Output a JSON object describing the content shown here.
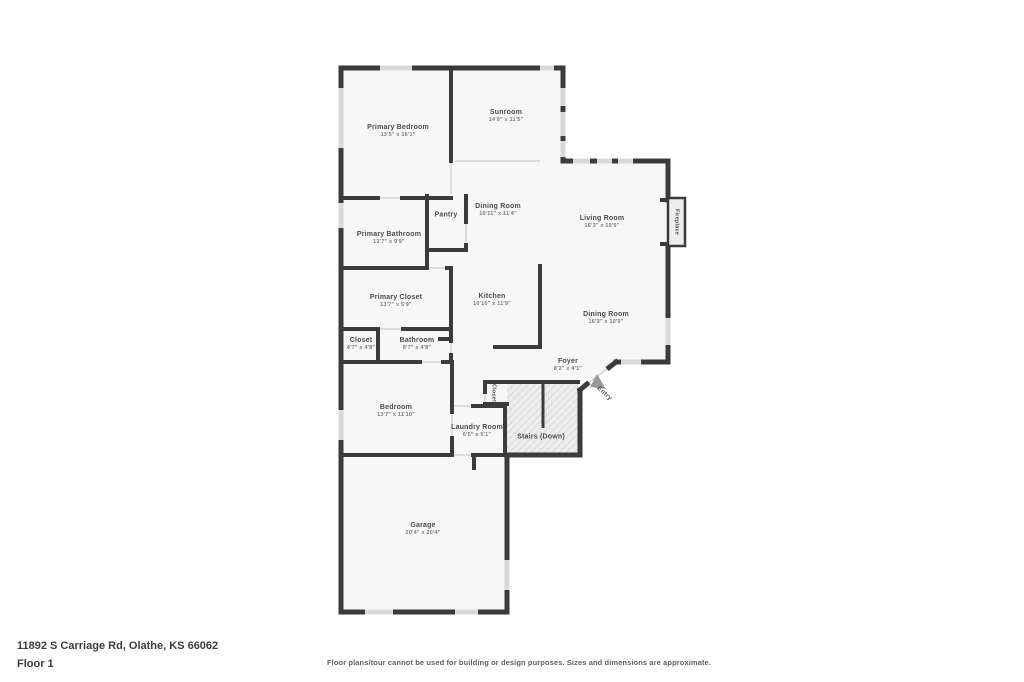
{
  "plan": {
    "rooms": [
      {
        "name": "Primary Bedroom",
        "dims": "13'5\" x 16'1\""
      },
      {
        "name": "Sunroom",
        "dims": "14'0\" x 11'5\""
      },
      {
        "name": "Dining Room",
        "dims": "10'11\" x 11'4\""
      },
      {
        "name": "Pantry",
        "dims": ""
      },
      {
        "name": "Living Room",
        "dims": "16'3\" x 15'5\""
      },
      {
        "name": "Primary Bathroom",
        "dims": "13'7\" x 9'9\""
      },
      {
        "name": "Primary Closet",
        "dims": "13'7\" x 5'9\""
      },
      {
        "name": "Kitchen",
        "dims": "10'10\" x 11'9\""
      },
      {
        "name": "Dining Room",
        "dims": "16'3\" x 10'0\""
      },
      {
        "name": "Closet",
        "dims": "4'7\" x 4'8\""
      },
      {
        "name": "Bathroom",
        "dims": "8'7\" x 4'8\""
      },
      {
        "name": "Foyer",
        "dims": "8'2\" x 4'1\""
      },
      {
        "name": "Bedroom",
        "dims": "13'7\" x 11'10\""
      },
      {
        "name": "Laundry Room",
        "dims": "6'5\" x 5'1\""
      },
      {
        "name": "Stairs (Down)",
        "dims": ""
      },
      {
        "name": "Garage",
        "dims": "20'4\" x 20'4\""
      },
      {
        "name": "Closet",
        "dims": ""
      },
      {
        "name": "Fireplace",
        "dims": ""
      },
      {
        "name": "Entry",
        "dims": ""
      }
    ],
    "colors": {
      "wall": "#3b3b3b",
      "floor": "#f7f7f7",
      "window": "#d9d9d9",
      "stairs_fill": "#ececec",
      "label": "#4a4a4a"
    }
  },
  "footer": {
    "address": "11892 S Carriage Rd, Olathe, KS 66062",
    "floor_label": "Floor 1",
    "disclaimer": "Floor plans/tour cannot be used for building or design purposes. Sizes and dimensions are approximate."
  }
}
